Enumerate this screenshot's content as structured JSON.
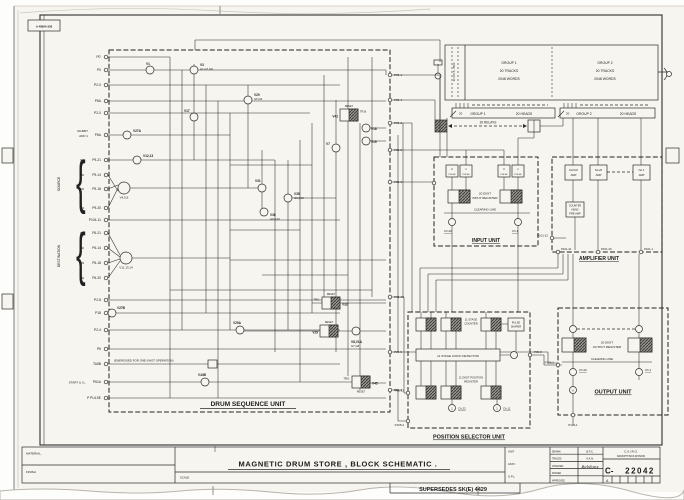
{
  "sheet": {
    "stamp": "A 4898A 936",
    "material": "MATERIAL,",
    "finish": "FINISH",
    "scale": "SCALE",
    "title": "MAGNETIC DRUM STORE , BLOCK SCHEMATIC .",
    "supersedes": "SUPERSEDES SK(E) 4429",
    "block": {
      "unit": "UNIT",
      "assy": "ASSY.",
      "gpl": "G.P.L.",
      "rows": [
        [
          "DRAWN",
          "B.F.C."
        ],
        [
          "TRACED",
          "V.A.N."
        ],
        [
          "CHECKED",
          "Belshaw"
        ],
        [
          "PASSED",
          ""
        ],
        [
          "APPROVED",
          ""
        ]
      ],
      "org1": "C.S.I.R.O.",
      "org2": "RADIOPHYSICS DIVISION",
      "number_prefix": "C-",
      "number": "22042",
      "revision": "A"
    }
  },
  "drum": {
    "spin_label": "30 R.P.S. 7860",
    "g1": [
      "GROUP 1",
      "20 TRACKS",
      "2048 WORDS"
    ],
    "g2": [
      "GROUP 2",
      "20 TRACKS",
      "2048 WORDS"
    ],
    "heads1": [
      "GROUP 1",
      "20 HEADS"
    ],
    "heads2": [
      "GROUP 2",
      "20 HEADS"
    ],
    "relays": "20 RELAYS",
    "tap1": "20",
    "tap2": "20"
  },
  "dsu": {
    "title": "DRUM SEQUENCE UNIT",
    "brace": "{",
    "source_label": "SOURCE",
    "dest_label": "DESTINATION",
    "inhibit": [
      "INHIBIT",
      "ADD 1"
    ],
    "start_label": "START & I.L.",
    "oneshot_note": "(ENERGISED FOR ONE-SHOT OPERATION)",
    "left_terminals": [
      {
        "label": "P0'",
        "y": 57
      },
      {
        "label": "P0",
        "y": 70
      },
      {
        "label": "P2-0",
        "y": 85
      },
      {
        "label": "P6A",
        "y": 101
      },
      {
        "label": "P2-0",
        "y": 113
      },
      {
        "label": "P6A",
        "y": 135
      },
      {
        "label": "P9-21",
        "y": 160,
        "tag": "M1"
      },
      {
        "label": "P9-14",
        "y": 175,
        "tag": "M2"
      },
      {
        "label": "P9-18",
        "y": 189,
        "tag": "M3"
      },
      {
        "label": "P9-20",
        "y": 208,
        "tag": "M4"
      },
      {
        "label": "P104-11",
        "y": 220
      },
      {
        "label": "P6-21",
        "y": 233,
        "tag": "M1"
      },
      {
        "label": "P6-14",
        "y": 248,
        "tag": "M2"
      },
      {
        "label": "P6-18",
        "y": 263,
        "tag": "M3"
      },
      {
        "label": "P6-20",
        "y": 278,
        "tag": "M4"
      },
      {
        "label": "P2-8",
        "y": 300
      },
      {
        "label": "P18",
        "y": 313
      },
      {
        "label": "P2-4",
        "y": 330
      },
      {
        "label": "P6",
        "y": 349
      },
      {
        "label": "TA5B",
        "y": 364
      },
      {
        "label": "P61A",
        "y": 382
      },
      {
        "label": "P PULSE",
        "y": 398
      }
    ],
    "right_terminals": [
      {
        "label": "P05-1",
        "y": 75
      },
      {
        "label": "P05-4",
        "y": 100
      },
      {
        "label": "P05-2",
        "y": 123
      },
      {
        "label": "P05-6",
        "y": 150
      },
      {
        "label": "P05-3",
        "y": 182
      },
      {
        "label": "P05-10",
        "y": 297
      },
      {
        "label": "P05-5",
        "y": 352
      },
      {
        "label": "P05-9",
        "y": 390
      }
    ],
    "nodes": [
      {
        "x": 150,
        "y": 70,
        "label": "V1",
        "lx": 146,
        "ly": 65
      },
      {
        "x": 194,
        "y": 70,
        "label": "V3",
        "sub": "G1,G7,G8",
        "lx": 200,
        "ly": 66
      },
      {
        "x": 248,
        "y": 100,
        "label": "V20",
        "sub": "G5,G6",
        "lx": 254,
        "ly": 96
      },
      {
        "x": 194,
        "y": 117,
        "label": "V17",
        "lx": 184,
        "ly": 112
      },
      {
        "x": 127,
        "y": 135,
        "label": "V27A",
        "lx": 133,
        "ly": 132
      },
      {
        "x": 137,
        "y": 160,
        "label": "V12,13",
        "lx": 143,
        "ly": 157
      },
      {
        "x": 124,
        "y": 188,
        "label": "",
        "sub": "V4,5,6"
      },
      {
        "x": 126,
        "y": 258,
        "label": "",
        "sub": "V11,13,14"
      },
      {
        "x": 262,
        "y": 188,
        "label": "V31",
        "lx": 255,
        "ly": 182
      },
      {
        "x": 288,
        "y": 198,
        "label": "V35",
        "sub": "G3,G10",
        "lx": 294,
        "ly": 195
      },
      {
        "x": 264,
        "y": 212,
        "label": "V36",
        "sub": "G9,G10",
        "lx": 270,
        "ly": 216
      },
      {
        "x": 336,
        "y": 148,
        "label": "V7",
        "lx": 326,
        "ly": 145
      },
      {
        "x": 366,
        "y": 128,
        "label": "V18",
        "lx": 371,
        "ly": 130
      },
      {
        "x": 366,
        "y": 141,
        "label": "V19",
        "lx": 371,
        "ly": 143
      },
      {
        "x": 356,
        "y": 331,
        "label": "V8,V1A",
        "sub": "G7,G8",
        "lx": 351,
        "ly": 343
      },
      {
        "x": 240,
        "y": 330,
        "label": "V25A",
        "lx": 233,
        "ly": 324
      },
      {
        "x": 205,
        "y": 382,
        "label": "V44B",
        "lx": 198,
        "ly": 376
      },
      {
        "x": 112,
        "y": 313,
        "label": "V27B",
        "lx": 117,
        "ly": 309
      }
    ],
    "ff_boxes": [
      {
        "x": 340,
        "y": 109,
        "label": "V41",
        "label_side": "l",
        "tag": "TR16",
        "tag_side": "r",
        "reset_pos": "t"
      },
      {
        "x": 322,
        "y": 297,
        "label": "V33",
        "label_side": "r",
        "tag": "TRIG.",
        "tag_side": "l",
        "reset_pos": "t"
      },
      {
        "x": 320,
        "y": 325,
        "label": "V29",
        "label_side": "l",
        "reset_pos": "t"
      },
      {
        "x": 352,
        "y": 376,
        "label": "V45",
        "label_side": "r",
        "tag": "TRIG.",
        "tag_side": "l",
        "reset_pos": "b"
      }
    ]
  },
  "input": {
    "title": "INPUT UNIT",
    "pulse_boxes": [
      {
        "x": 446,
        "t": "0",
        "b": "PULSE"
      },
      {
        "x": 460,
        "t": "1",
        "b": "PULSE"
      },
      {
        "x": 498,
        "t": "0",
        "b": "PULSE"
      },
      {
        "x": 512,
        "t": "1",
        "b": "PULSE"
      }
    ],
    "register": [
      "20 DIGIT",
      "INPUT REGISTER"
    ],
    "clearing": "CLEARING LINE",
    "ch_left": "Ch.20",
    "ch_right": "Ch.1"
  },
  "amp": {
    "title": "AMPLIFIER UNIT",
    "boxes": [
      {
        "x": 565,
        "lines": [
          "CLOCK",
          "AMP"
        ]
      },
      {
        "x": 590,
        "lines": [
          "No.20",
          "AMP"
        ]
      },
      {
        "x": 633,
        "lines": [
          "No.1",
          "AMP"
        ]
      }
    ],
    "preamp": [
      "COUNTER",
      "HEAD",
      "PRE-AMP"
    ],
    "terminals": [
      {
        "label": "P101-21",
        "x": 558
      },
      {
        "label": "P101-20",
        "x": 598
      },
      {
        "label": "P101-1",
        "x": 641
      }
    ],
    "left_terminal": "P101-12"
  },
  "selector": {
    "title": "POSITION SELECTOR UNIT",
    "counter": [
      "11 STAGE",
      "COUNTER"
    ],
    "coinc": "11 STAGE  COINC  DETECTOR",
    "posreg": [
      "11 DIGIT POSITION",
      "REGISTER"
    ],
    "shaper": [
      "PULSE",
      "SHAPER"
    ],
    "ch_left": "Ch.22",
    "ch_right": "Ch.11",
    "circ_left": "2",
    "circ_right": "1",
    "t_right": "P05-8",
    "t_left": "P05-12",
    "t_bottom": "P105-4"
  },
  "output": {
    "title": "OUTPUT UNIT",
    "register": [
      "20 DIGIT",
      "OUTPUT REGISTER"
    ],
    "clearing": "CLEARING LINE",
    "ch_left": "Ch.20",
    "ch_right": "Ch.1",
    "circ_a": "A",
    "t_bottom": "P105-1",
    "t_left": "P105-2"
  }
}
